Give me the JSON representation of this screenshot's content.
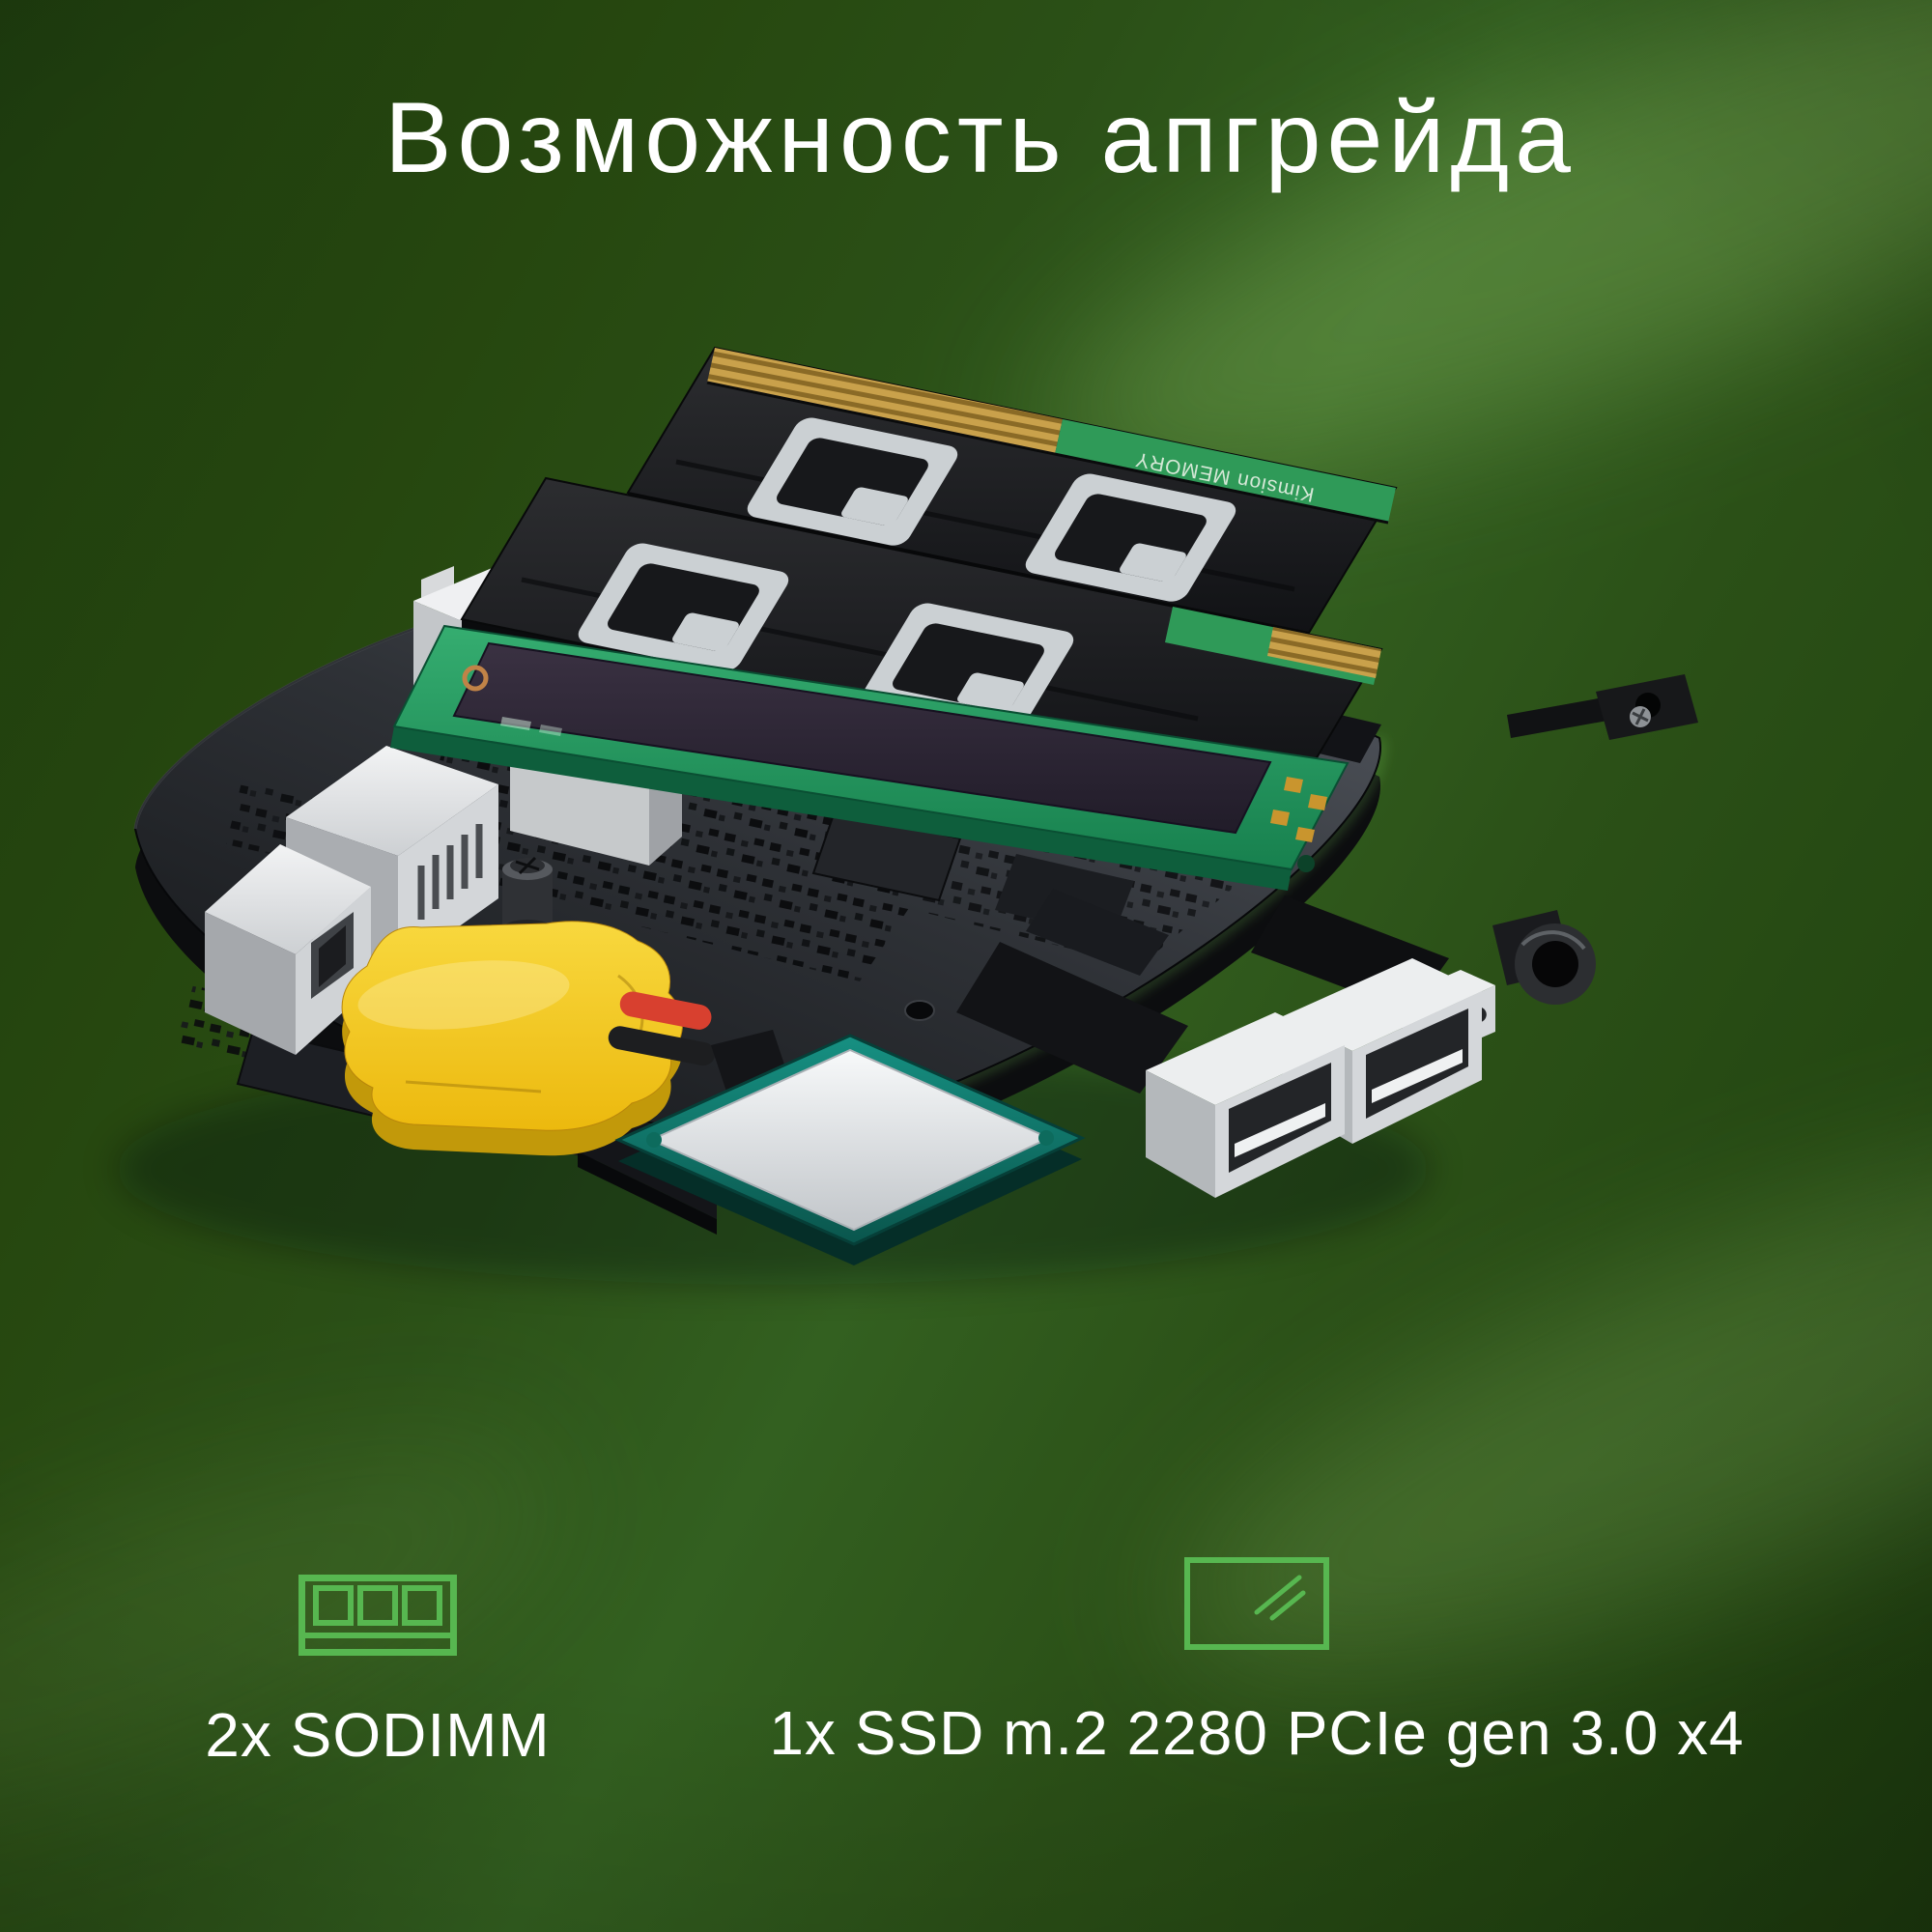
{
  "title": "Возможность апгрейда",
  "features": [
    {
      "id": "sodimm",
      "icon": "sodimm-icon",
      "label": "2x SODIMM"
    },
    {
      "id": "ssd",
      "icon": "ssd-icon",
      "label": "1x SSD m.2 2280 PCIe gen 3.0 x4"
    }
  ],
  "scene": {
    "alt": "Exploded 3D render of a mini-PC motherboard with two SO-DIMM RAM modules, an M.2 SSD, yellow CMOS battery, CPU and USB ports",
    "ram_module_print": "Kimsion MEMORY"
  },
  "colors": {
    "accent": "#57b750",
    "text": "#ffffff",
    "bg_base": "#2b5017",
    "bg_dark": "#1d3b0e",
    "bg_light": "#40702a"
  }
}
